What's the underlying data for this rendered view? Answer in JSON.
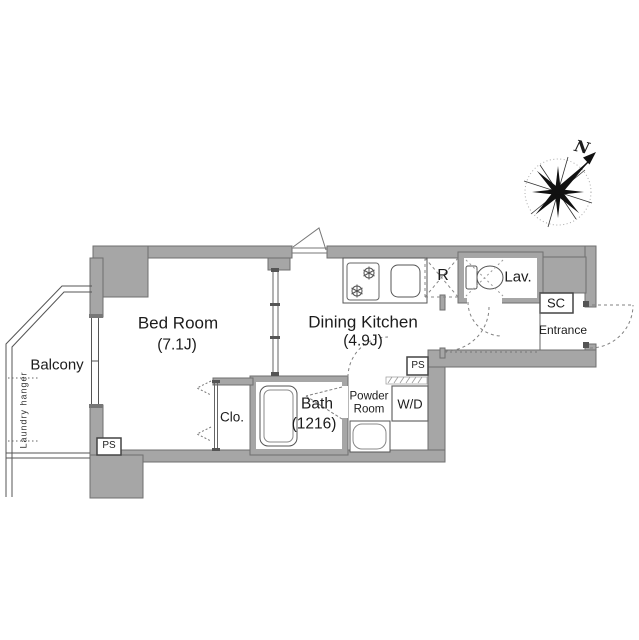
{
  "document_type": "apartment-floor-plan",
  "colors": {
    "wall_fill": "#a6a6a6",
    "wall_border": "#6f6f6f",
    "line": "#555555",
    "dash": "#808080",
    "text": "#1c1c1c",
    "background": "#ffffff"
  },
  "compass": {
    "north_label": "N"
  },
  "rooms": {
    "bedroom": {
      "name": "Bed Room",
      "size": "(7.1J)"
    },
    "dining_kitchen": {
      "name": "Dining Kitchen",
      "size": "(4.9J)"
    },
    "balcony": {
      "name": "Balcony",
      "laundry_hanger": "Laundry hanger"
    },
    "closet": {
      "label": "Clo."
    },
    "bath": {
      "name": "Bath",
      "size": "(1216)"
    },
    "powder_room": {
      "name_line1": "Powder",
      "name_line2": "Room"
    },
    "washer_dryer": {
      "label": "W/D"
    },
    "refrigerator_space": {
      "label": "R"
    },
    "lavatory": {
      "label": "Lav."
    },
    "shoe_closet": {
      "label": "SC"
    },
    "entrance": {
      "name": "Entrance"
    },
    "pipe_shaft_bedroom": {
      "label": "PS"
    },
    "pipe_shaft_kitchen": {
      "label": "PS"
    }
  }
}
